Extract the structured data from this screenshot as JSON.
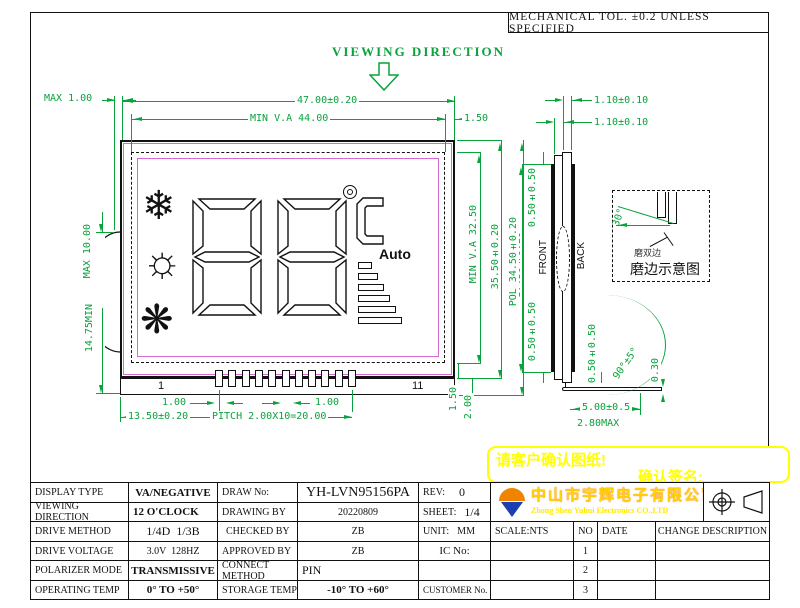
{
  "header": {
    "tol_note": "MECHANICAL TOL. ±0.2 UNLESS SPECIFIED",
    "viewing_direction": "VIEWING DIRECTION"
  },
  "front_view": {
    "dim_max_offset": "MAX 1.00",
    "dim_width": "47.00±0.20",
    "dim_va_width": "MIN V.A 44.00",
    "dim_right_margin": "1.50",
    "dim_va_height": "MIN V.A 32.50",
    "dim_glass_height": "35.50±0.20",
    "dim_total_height": "37.50±0.20",
    "dim_bump": "MAX 10.00",
    "dim_bump_pos": "14.75MIN",
    "dim_pin_width_left": "1.00",
    "dim_pin_width_mid": "1.00",
    "dim_pin_offset": "13.50±0.20",
    "dim_pitch": "PITCH  2.00X10=20.00",
    "dim_bottom_margin": "1.50",
    "dim_strip_height": "2.00",
    "pin_first": "1",
    "pin_last": "11",
    "pin_count": 11,
    "lcd": {
      "auto_label": "Auto",
      "icon_snowflake": "❄",
      "icon_sun": "☼",
      "icon_fan": "❋",
      "bar_widths": [
        14,
        20,
        26,
        32,
        38,
        44
      ]
    }
  },
  "side_view": {
    "dim_glass1": "1.10±0.10",
    "dim_glass2": "1.10±0.10",
    "dim_pol_top": "0.50±0.50",
    "dim_pol": "POL 34.50±0.20",
    "dim_pol_bottom": "0.50±0.50",
    "label_front": "FRONT",
    "label_back": "BACK",
    "dim_pin_side": "0.50±0.50",
    "dim_bend_angle": "90°±5°",
    "dim_foot_thickness": "0.30",
    "dim_pin_length": "5.00±0.5",
    "dim_foot_max": "2.80MAX"
  },
  "detail_view": {
    "angle": "30°",
    "edge_note": "磨双边",
    "caption": "磨边示意图"
  },
  "note": {
    "line1": "请客户确认图纸!",
    "line2": "确认签名:"
  },
  "company": {
    "name_cn": "中山市宇辉电子有限公司",
    "name_en": "Zhong Shen Yuhui Electronics CO.,LTD"
  },
  "title_block": {
    "display_type_label": "DISPLAY TYPE",
    "display_type": "VA/NEGATIVE",
    "draw_no_label": "DRAW No:",
    "draw_no": "YH-LVN95156PA",
    "rev_label": "REV:",
    "rev": "0",
    "viewing_label": "VIEWING DIRECTION",
    "viewing": "12 O'CLOCK",
    "drawing_by_label": "DRAWING BY",
    "drawing_by": "20220809",
    "sheet_label": "SHEET:",
    "sheet": "1/4",
    "drive_method_label": "DRIVE METHOD",
    "drive_method": "1/4D  1/3B",
    "checked_label": "CHECKED BY",
    "checked": "ZB",
    "unit_label": "UNIT:",
    "unit": "MM",
    "scale": "SCALE:NTS",
    "no_header": "NO",
    "date_header": "DATE",
    "change_header": "CHANGE DESCRIPTION",
    "drive_voltage_label": "DRIVE VOLTAGE",
    "drive_voltage": "3.0V  128HZ",
    "approved_label": "APPROVED BY",
    "approved": "ZB",
    "ic_label": "IC No:",
    "polarizer_label": "POLARIZER MODE",
    "polarizer": "TRANSMISSIVE",
    "connect_label": "CONNECT METHOD",
    "connect": "PIN",
    "operating_label": "OPERATING TEMP",
    "operating": "0° TO +50°",
    "storage_label": "STORAGE TEMP",
    "storage": "-10° TO +60°",
    "customer_label": "CUSTOMER No.",
    "revisions": [
      {
        "no": "1",
        "date": "",
        "desc": ""
      },
      {
        "no": "2",
        "date": "",
        "desc": ""
      },
      {
        "no": "3",
        "date": "",
        "desc": ""
      }
    ]
  },
  "colors": {
    "dim_green": "#0aa23c",
    "lcd_magenta": "#d46ad4",
    "note_yellow": "#ffff00",
    "logo_orange": "#f08300",
    "logo_blue": "#1b3fae",
    "company_yellow": "#ffd400"
  }
}
